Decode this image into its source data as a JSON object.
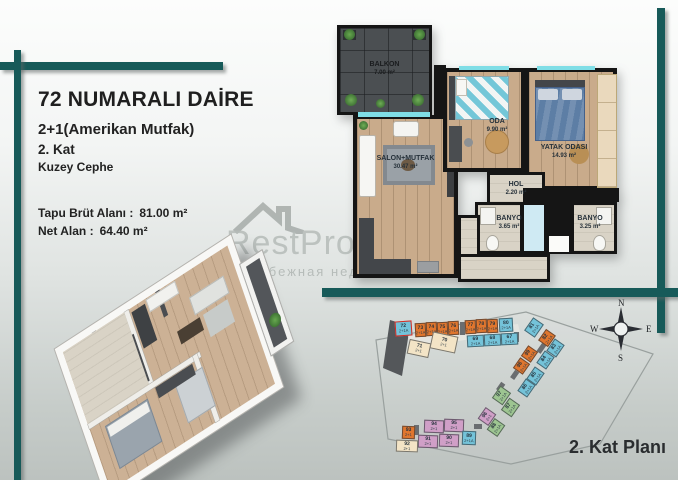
{
  "info_panel": {
    "title": "72 NUMARALI DAİRE",
    "subtitle": "2+1(Amerikan Mutfak)",
    "floor": "2. Kat",
    "facade": "Kuzey Cephe",
    "gross_label": "Tapu Brüt Alanı :",
    "gross_value": "81.00 m²",
    "net_label": "Net Alan :",
    "net_value": "64.40 m²"
  },
  "watermark": {
    "brand": "RestProperty",
    "subtitle": "Зарубежная недвижимость"
  },
  "floor_plan": {
    "rooms": [
      {
        "id": "balkon",
        "label": "BALKON",
        "area": "7.00 m²"
      },
      {
        "id": "salon",
        "label": "SALON+MUTFAK",
        "area": "30.47 m²"
      },
      {
        "id": "oda",
        "label": "ODA",
        "area": "9.90 m²"
      },
      {
        "id": "yatak",
        "label": "YATAK ODASI",
        "area": "14.93 m²"
      },
      {
        "id": "hol",
        "label": "HOL",
        "area": "2.20 m²"
      },
      {
        "id": "banyo_l",
        "label": "BANYO",
        "area": "3.65 m²"
      },
      {
        "id": "banyo_r",
        "label": "BANYO",
        "area": "3.25 m²"
      }
    ]
  },
  "site_plan": {
    "caption": "2. Kat Planı",
    "compass": {
      "n": "N",
      "s": "S",
      "e": "E",
      "w": "W"
    },
    "highlight_unit": "72",
    "colors": {
      "orange": "#e0762e",
      "teal": "#74c3d9",
      "cream": "#f3e4c6",
      "pink": "#d09fc7",
      "green": "#9dc591",
      "dark": "#55585b",
      "highlight": "#d92b21"
    },
    "units": [
      {
        "num": "72",
        "type": "2+1A",
        "color": "teal",
        "x": 27,
        "y": 25,
        "w": 17,
        "h": 15,
        "rot": -4,
        "highlight": true
      },
      {
        "num": "73",
        "type": "2+1A",
        "color": "orange",
        "x": 47,
        "y": 27,
        "w": 11,
        "h": 14,
        "rot": -3
      },
      {
        "num": "74",
        "type": "2+1A",
        "color": "orange",
        "x": 58,
        "y": 26,
        "w": 11,
        "h": 14,
        "rot": -3
      },
      {
        "num": "75",
        "type": "2+1A",
        "color": "orange",
        "x": 69,
        "y": 26,
        "w": 11,
        "h": 14,
        "rot": -3
      },
      {
        "num": "76",
        "type": "2+1A",
        "color": "orange",
        "x": 80,
        "y": 25,
        "w": 11,
        "h": 14,
        "rot": -3
      },
      {
        "num": "77",
        "type": "2+1A",
        "color": "orange",
        "x": 97,
        "y": 24,
        "w": 11,
        "h": 14,
        "rot": -3
      },
      {
        "num": "78",
        "type": "2+1A",
        "color": "orange",
        "x": 108,
        "y": 23,
        "w": 11,
        "h": 14,
        "rot": -3
      },
      {
        "num": "79",
        "type": "2+1A",
        "color": "orange",
        "x": 119,
        "y": 23,
        "w": 11,
        "h": 14,
        "rot": -3
      },
      {
        "num": "80",
        "type": "2+1A",
        "color": "teal",
        "x": 131,
        "y": 22,
        "w": 14,
        "h": 14,
        "rot": -3
      },
      {
        "num": "69",
        "type": "2+1A",
        "color": "teal",
        "x": 99,
        "y": 39,
        "w": 17,
        "h": 12,
        "rot": -3
      },
      {
        "num": "68",
        "type": "2+1A",
        "color": "teal",
        "x": 116,
        "y": 38,
        "w": 17,
        "h": 12,
        "rot": -3
      },
      {
        "num": "67",
        "type": "2+1A",
        "color": "teal",
        "x": 133,
        "y": 37,
        "w": 17,
        "h": 12,
        "rot": -3
      },
      {
        "num": "71",
        "type": "2+1",
        "color": "cream",
        "x": 40,
        "y": 45,
        "w": 22,
        "h": 15,
        "rot": 12
      },
      {
        "num": "70",
        "type": "2+1",
        "color": "cream",
        "x": 63,
        "y": 38,
        "w": 26,
        "h": 17,
        "rot": 12
      },
      {
        "num": "81",
        "type": "2+1A",
        "color": "teal",
        "x": 158,
        "y": 25,
        "w": 16,
        "h": 13,
        "rot": -55
      },
      {
        "num": "82",
        "type": "2+1A",
        "color": "orange",
        "x": 172,
        "y": 36,
        "w": 14,
        "h": 12,
        "rot": -55
      },
      {
        "num": "83",
        "type": "2+1A",
        "color": "teal",
        "x": 180,
        "y": 46,
        "w": 15,
        "h": 12,
        "rot": -55
      },
      {
        "num": "84",
        "type": "2+1A",
        "color": "teal",
        "x": 170,
        "y": 58,
        "w": 15,
        "h": 12,
        "rot": -55
      },
      {
        "num": "99",
        "type": "2+1A",
        "color": "orange",
        "x": 155,
        "y": 52,
        "w": 13,
        "h": 12,
        "rot": -55
      },
      {
        "num": "98",
        "type": "2+1A",
        "color": "orange",
        "x": 147,
        "y": 64,
        "w": 13,
        "h": 12,
        "rot": -55
      },
      {
        "num": "85",
        "type": "2+1A",
        "color": "teal",
        "x": 160,
        "y": 74,
        "w": 15,
        "h": 12,
        "rot": -55
      },
      {
        "num": "86",
        "type": "2+1A",
        "color": "teal",
        "x": 151,
        "y": 86,
        "w": 15,
        "h": 12,
        "rot": -55
      },
      {
        "num": "97",
        "type": "2+1A",
        "color": "green",
        "x": 126,
        "y": 93,
        "w": 15,
        "h": 13,
        "rot": -55
      },
      {
        "num": "87",
        "type": "2+1A",
        "color": "green",
        "x": 135,
        "y": 105,
        "w": 15,
        "h": 13,
        "rot": -55
      },
      {
        "num": "96",
        "type": "2+1",
        "color": "pink",
        "x": 112,
        "y": 114,
        "w": 14,
        "h": 13,
        "rot": -55
      },
      {
        "num": "88",
        "type": "2+1A",
        "color": "green",
        "x": 121,
        "y": 125,
        "w": 14,
        "h": 13,
        "rot": -55
      },
      {
        "num": "94",
        "type": "2+1",
        "color": "pink",
        "x": 56,
        "y": 124,
        "w": 20,
        "h": 13,
        "rot": 2
      },
      {
        "num": "95",
        "type": "2+1",
        "color": "pink",
        "x": 76,
        "y": 123,
        "w": 20,
        "h": 13,
        "rot": 2
      },
      {
        "num": "93",
        "type": "2+1",
        "color": "orange",
        "x": 34,
        "y": 130,
        "w": 13,
        "h": 13,
        "rot": 2
      },
      {
        "num": "91",
        "type": "2+1",
        "color": "pink",
        "x": 50,
        "y": 139,
        "w": 20,
        "h": 13,
        "rot": 2
      },
      {
        "num": "90",
        "type": "2+1",
        "color": "pink",
        "x": 71,
        "y": 138,
        "w": 20,
        "h": 13,
        "rot": 2
      },
      {
        "num": "89",
        "type": "2+1A",
        "color": "teal",
        "x": 94,
        "y": 135,
        "w": 14,
        "h": 14,
        "rot": 2
      },
      {
        "num": "92",
        "type": "2+1",
        "color": "cream",
        "x": 28,
        "y": 144,
        "w": 22,
        "h": 12,
        "rot": 2
      }
    ]
  }
}
